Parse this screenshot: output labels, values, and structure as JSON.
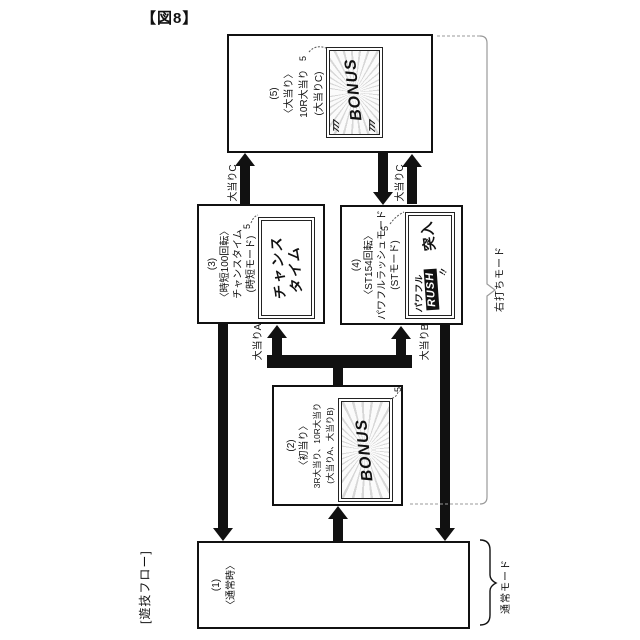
{
  "figure": {
    "title": "【図8】",
    "flow_label": "[遊技フロー]"
  },
  "boxes": {
    "b1": {
      "lines": [
        "(1)",
        "〈通常時〉"
      ]
    },
    "b2": {
      "lines": [
        "(2)",
        "〈初当り〉",
        "3R大当り、10R大当り",
        "(大当りA、大当りB)"
      ],
      "screen_text": "BONUS",
      "ref": "5"
    },
    "b3": {
      "lines": [
        "(3)",
        "〈時短100回転〉",
        "チャンスタイム",
        "(時短モード)"
      ],
      "screen_lines": [
        "チャンス",
        "タイム"
      ],
      "ref": "5"
    },
    "b4": {
      "lines": [
        "(4)",
        "〈ST154回転〉",
        "パワフルラッシュモード",
        "(STモード)"
      ],
      "screen": {
        "top": "パワフル",
        "mid": "RUSH",
        "main": "突入",
        "excl": "!!"
      },
      "ref": "5"
    },
    "b5": {
      "lines": [
        "(5)",
        "〈大当り〉",
        "10R大当り",
        "(大当りC)"
      ],
      "screen_text": "BONUS",
      "sevens": "777",
      "ref": "5"
    }
  },
  "arrow_labels": {
    "c_from3_to5": "大当りC",
    "c_from4_to5": "大当りC",
    "a_to3": "大当りA",
    "b_to4": "大当りB"
  },
  "mode_labels": {
    "right_strike": "右打ちモード",
    "normal": "通常モード"
  },
  "colors": {
    "line": "#111111",
    "bracket_gray": "#999999",
    "background": "#ffffff"
  }
}
